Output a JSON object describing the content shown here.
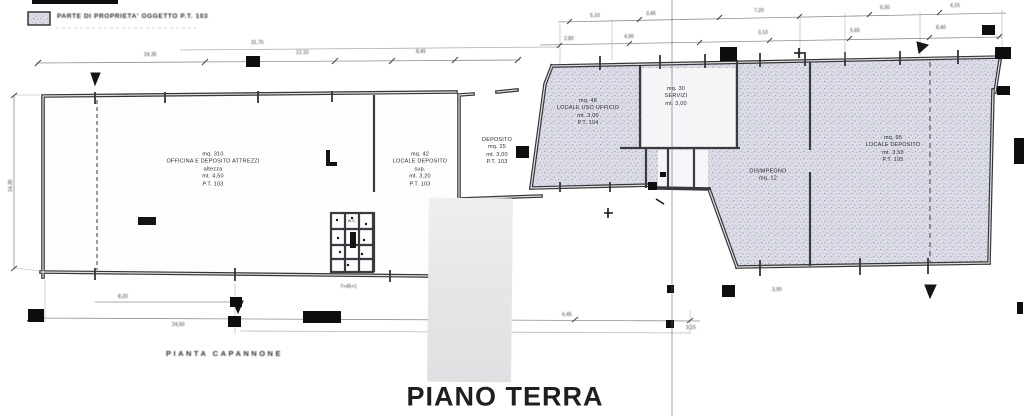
{
  "titles": {
    "main": "PIANO TERRA",
    "sub": "PIANTA CAPANNONE"
  },
  "legend": {
    "label": "PARTE DI PROPRIETA' OGGETTO P.T. 103",
    "swatch": "stipple-hatch"
  },
  "rooms": {
    "left_main": {
      "label": "mq. 310\nOFFICINA E DEPOSITO ATTREZZI\naltezza\nmt. 4,50\nP.T. 103"
    },
    "left_second": {
      "label": "mq. 42\nLOCALE DEPOSITO\nsup.\nmt. 3,20\nP.T. 103"
    },
    "wc_small": {
      "label": "w.c."
    },
    "middle": {
      "label": "DEPOSITO\nmq. 25\nmt. 3,00\nP.T. 103"
    },
    "right_a": {
      "label": "mq. 48\nLOCALE USO UFFICIO\nmt. 3,00\nP.T. 104"
    },
    "right_top": {
      "label": "mq. 30\nSERVIZI\nmt. 3,00"
    },
    "corridor": {
      "label": "DISIMPEGNO\nmq. 12"
    },
    "right_main": {
      "label": "mq. 95\nLOCALE DEPOSITO\nmt. 3,50\nP.T. 105"
    }
  },
  "dims": {
    "t1": "24,35",
    "t2": "12,10",
    "t3": "8,45",
    "t4": "31,70",
    "lv": "14,35",
    "r1": "5,10",
    "r2": "3,45",
    "r3": "7,20",
    "r4": "6,30",
    "r5": "4,15",
    "s1": "2,80",
    "s2": "4,90",
    "s3": "3,10",
    "s4": "5,65",
    "s5": "8,40",
    "b1": "8,20",
    "b2": "24,50",
    "b3": "6,45",
    "b4": "3,15",
    "wc_note": "7+45+1",
    "br1": "3,90"
  },
  "colors": {
    "wall": "#35353a",
    "stipple_base": "#dcdde6",
    "stipple_dot": "#a3a6bb",
    "dim_line": "#8e8e96",
    "artifact": "#111111",
    "patch": "#e8e8ea"
  }
}
